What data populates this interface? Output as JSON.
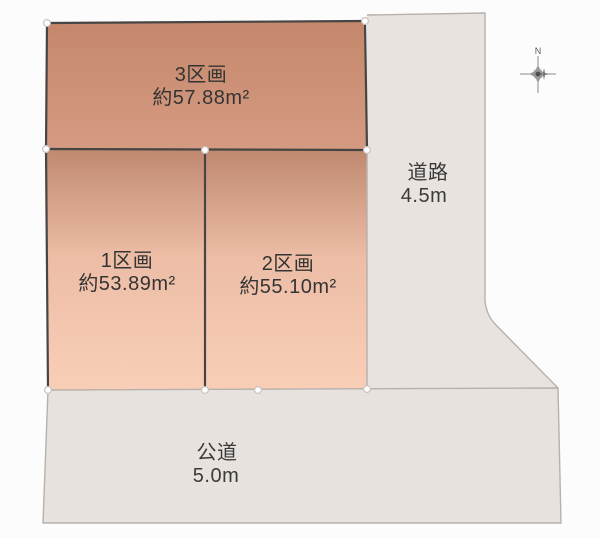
{
  "parcels": [
    {
      "name": "1区画",
      "area": "約53.89m²"
    },
    {
      "name": "2区画",
      "area": "約55.10m²"
    },
    {
      "name": "3区画",
      "area": "約57.88m²"
    }
  ],
  "roads": [
    {
      "name": "道路",
      "width": "4.5m"
    },
    {
      "name": "公道",
      "width": "5.0m"
    }
  ],
  "compass": {
    "north_label": "N"
  },
  "colors": {
    "parcel3_top": "#c4876b",
    "parcel3_bottom": "#d59b82",
    "parcel_top": "#bf8970",
    "parcel_mid": "#edbda6",
    "parcel_bottom": "#f9ceb7",
    "road_fill": "#e8e3de",
    "public_road_fill": "#e7e2dd",
    "dark_border": "#474544",
    "light_border": "#b6b1ac",
    "background": "#fcfcfc",
    "text": "#343434"
  }
}
